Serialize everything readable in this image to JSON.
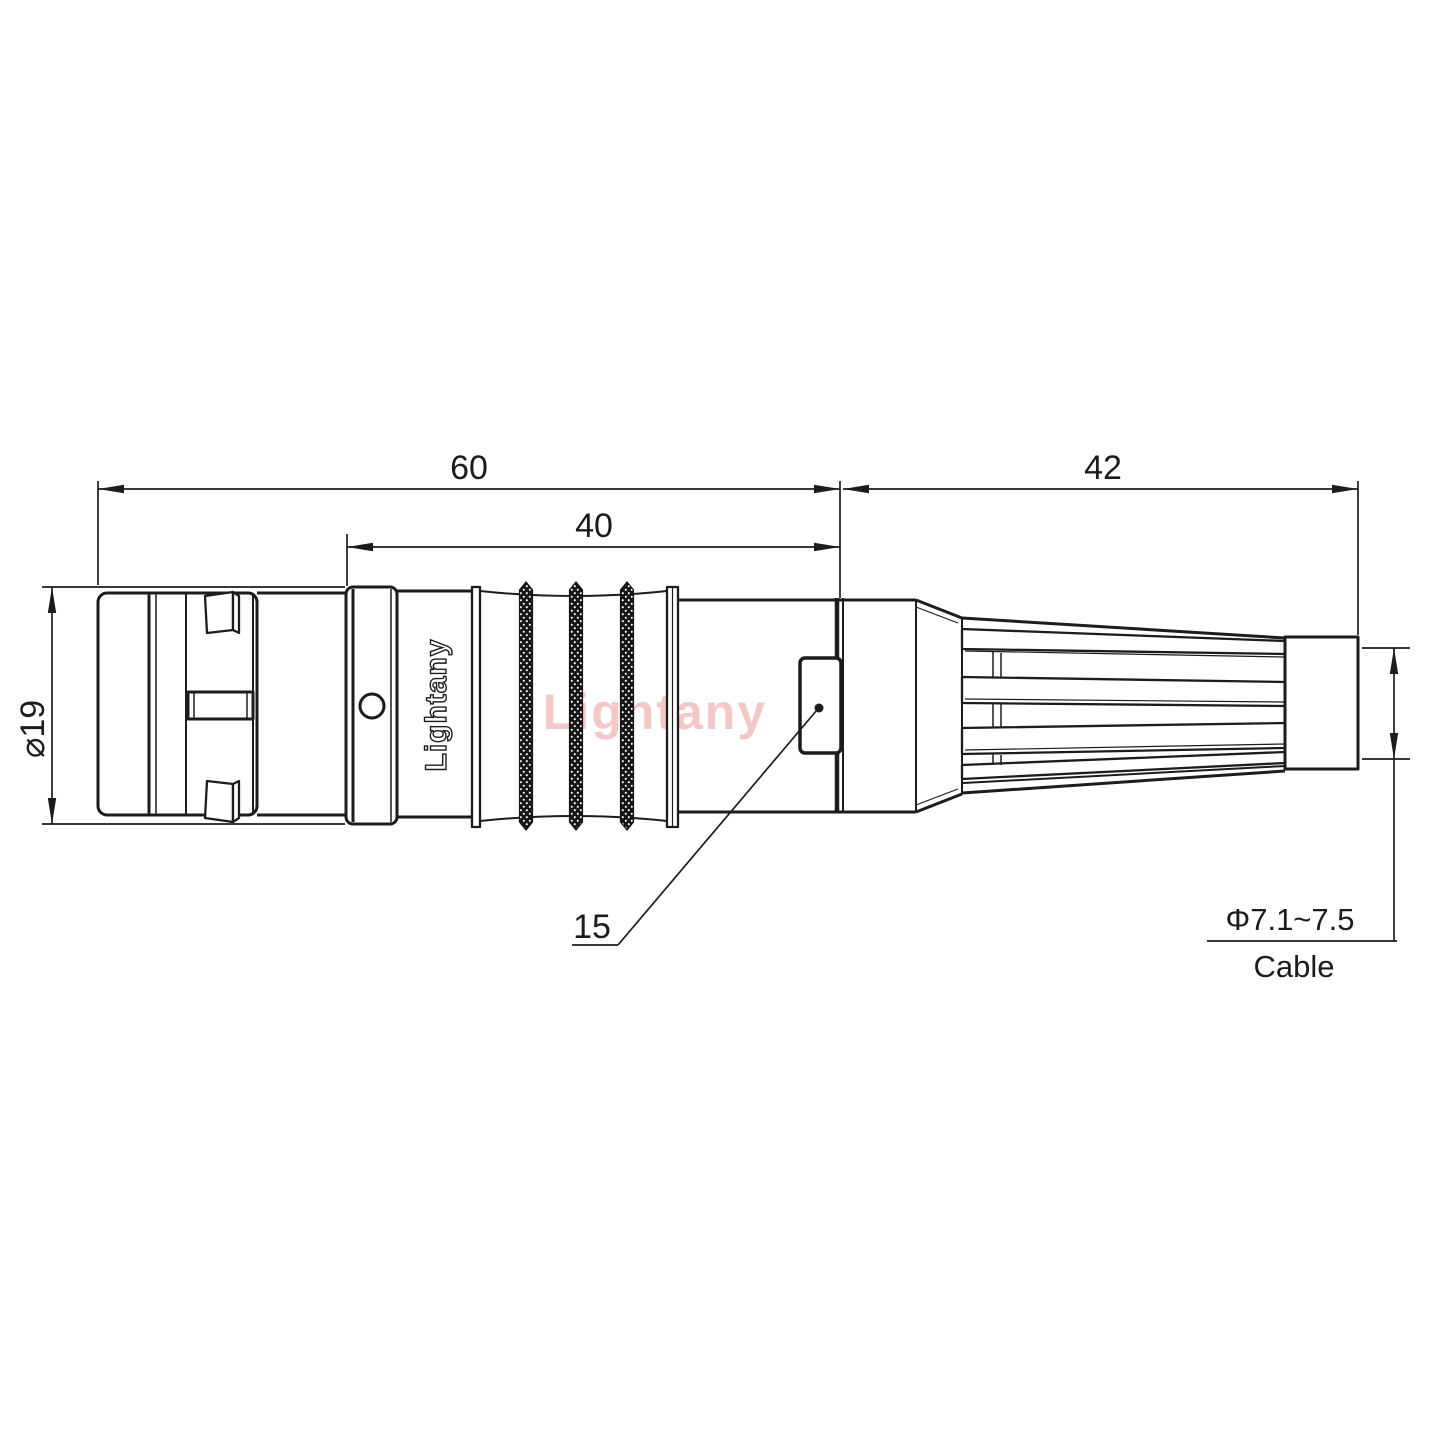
{
  "drawing": {
    "dim_overall": "60",
    "dim_mid": "40",
    "dim_rear": "42",
    "dim_front_diameter": "⌀19",
    "dim_tab_ref": "15",
    "dim_cable_diameter": "Φ7.1~7.5",
    "dim_cable_caption": "Cable"
  },
  "branding": {
    "engraving": "Lightany",
    "watermark": "Lightany"
  },
  "colors": {
    "line": "#1c1c1c",
    "watermark_pink": "#f5c8c8",
    "background": "#ffffff"
  }
}
